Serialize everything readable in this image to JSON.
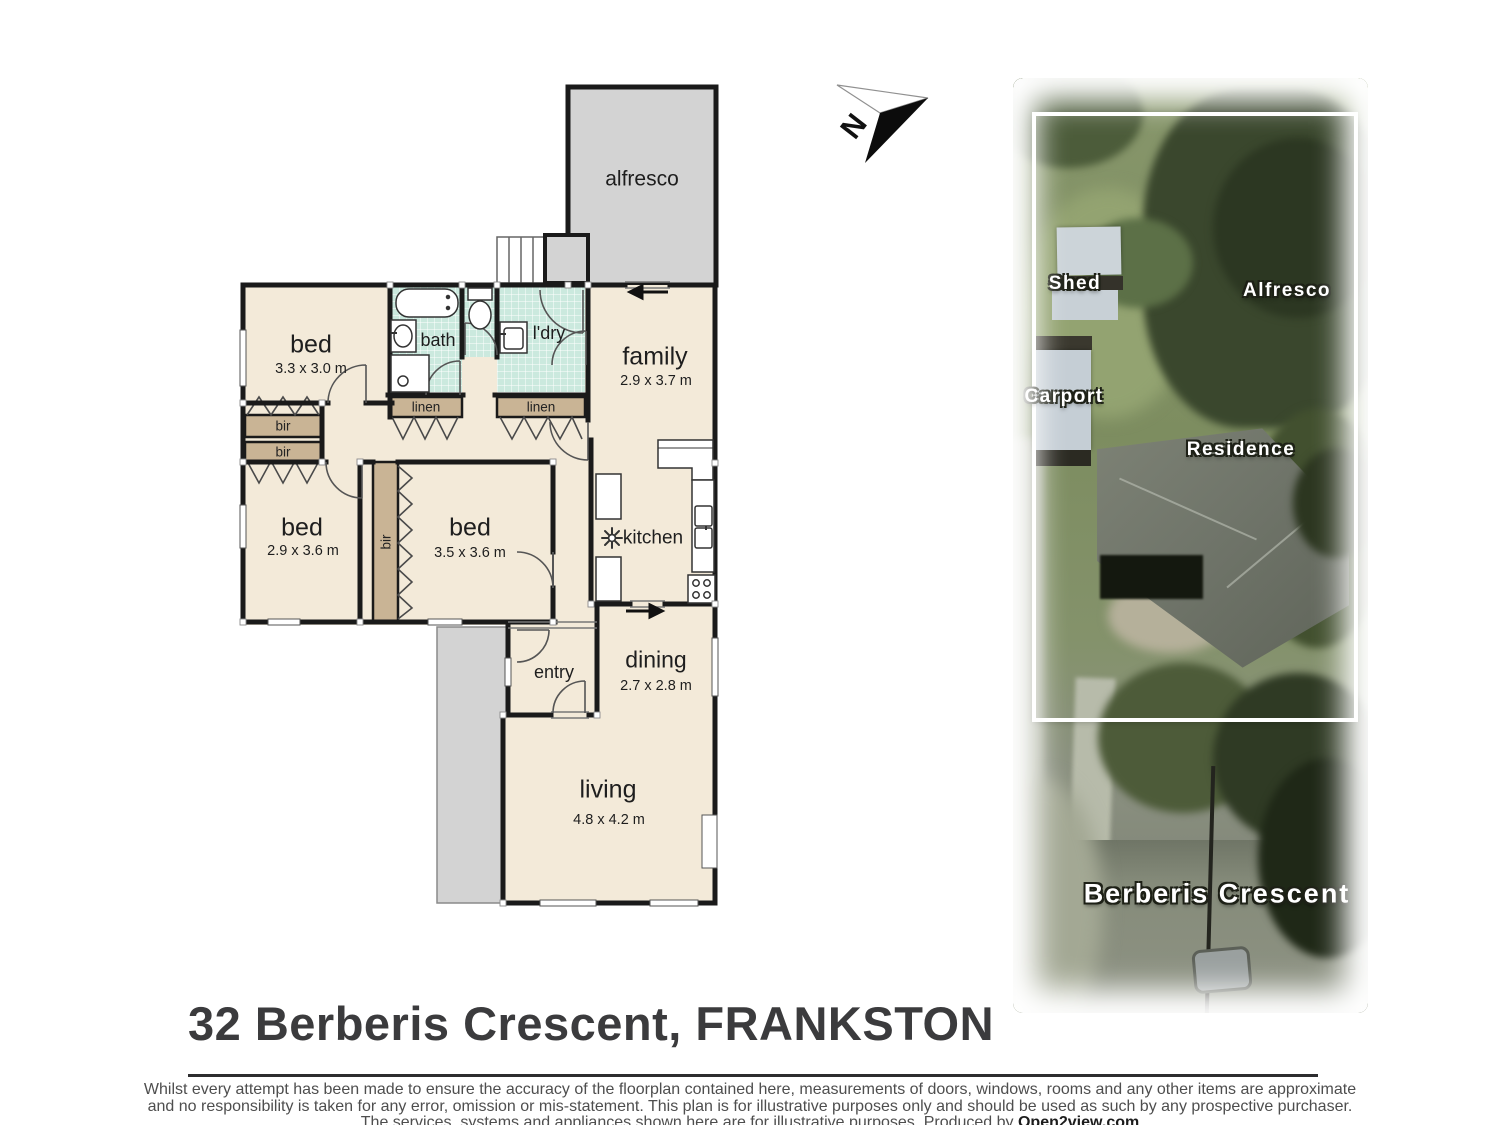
{
  "colors": {
    "wall": "#1a1a1a",
    "room_fill": "#f3ead9",
    "closet_fill": "#c9b495",
    "tile_fill": "#cbe9de",
    "outdoor_gray": "#d3d3d3",
    "title_text": "#3b3b3d",
    "disclaimer_text": "#4e4e4e",
    "aerial_label_text": "#ffffff"
  },
  "north_arrow": {
    "label": "N"
  },
  "floorplan": {
    "rooms": {
      "alfresco": {
        "name": "alfresco",
        "dims": ""
      },
      "bed1": {
        "name": "bed",
        "dims": "3.3 x 3.0 m"
      },
      "bath": {
        "name": "bath",
        "dims": ""
      },
      "ldry": {
        "name": "l'dry",
        "dims": ""
      },
      "family": {
        "name": "family",
        "dims": "2.9 x 3.7 m"
      },
      "bed2": {
        "name": "bed",
        "dims": "2.9 x 3.6 m"
      },
      "bed3": {
        "name": "bed",
        "dims": "3.5 x 3.6 m"
      },
      "kitchen": {
        "name": "kitchen",
        "dims": ""
      },
      "entry": {
        "name": "entry",
        "dims": ""
      },
      "dining": {
        "name": "dining",
        "dims": "2.7 x 2.8 m"
      },
      "living": {
        "name": "living",
        "dims": "4.8 x 4.2 m"
      }
    },
    "closets": {
      "bir1": "bir",
      "bir2": "bir",
      "bir3": "bir",
      "linen1": "linen",
      "linen2": "linen"
    }
  },
  "aerial": {
    "labels": {
      "shed": "Shed",
      "alfresco": "Alfresco",
      "carport": "Carport",
      "residence": "Residence",
      "street": "Berberis Crescent"
    }
  },
  "footer": {
    "title": "32 Berberis Crescent, FRANKSTON",
    "disclaimer_line1": "Whilst every attempt has been made to ensure the accuracy of the floorplan contained here, measurements of doors, windows, rooms and any other items are approximate",
    "disclaimer_line2": "and no responsibility is taken for any error, omission or mis-statement.  This plan is for illustrative purposes only and should be used as such by any prospective purchaser.",
    "disclaimer_line3": "The services, systems and appliances shown here are for illustrative purposes.   Produced by ",
    "producer": "Open2view.com"
  }
}
